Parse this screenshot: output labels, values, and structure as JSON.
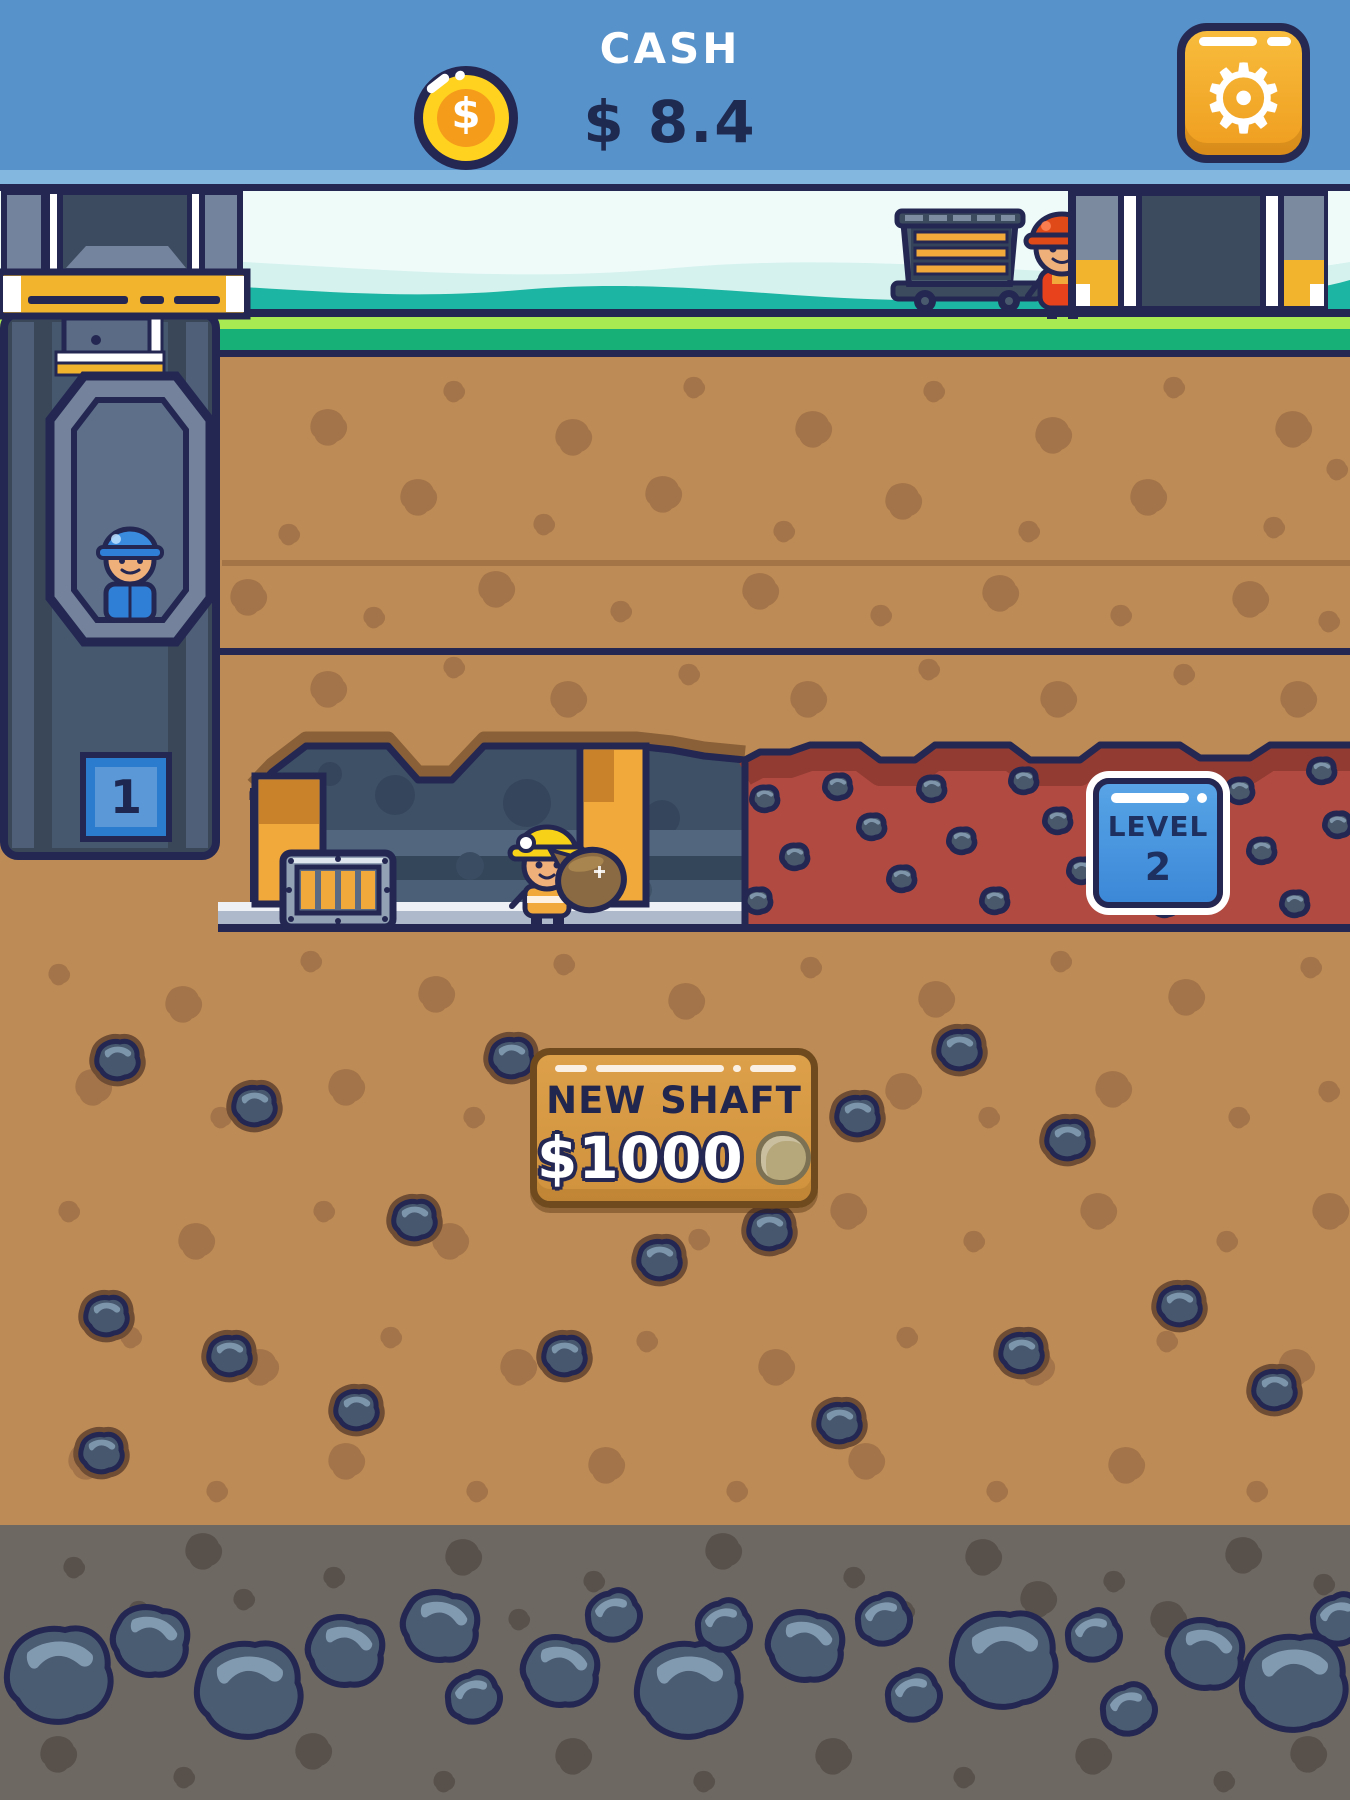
{
  "header": {
    "title": "CASH",
    "cash_value": "$ 8.4",
    "coin_symbol": "$",
    "gear_glyph": "⚙"
  },
  "shaft1": {
    "badge": "1"
  },
  "level2": {
    "label": "LEVEL",
    "number": "2"
  },
  "new_shaft": {
    "title": "NEW SHAFT",
    "price": "$1000"
  },
  "icons": {
    "coin": "dollar-coin-icon",
    "settings": "gear-icon",
    "nugget": "ore-nugget-icon"
  },
  "colors": {
    "header_blue": "#5892cb",
    "header_strip": "#84b7e0",
    "outline_navy": "#232752",
    "sky": "#eefbf9",
    "hills_teal": "#1cb4a2",
    "grass_light": "#a8ea52",
    "grass_dark": "#17b077",
    "dirt": "#bd8b55",
    "tunnel": "#3e5066",
    "wood_post": "#f2a93c",
    "red_zone": "#b14b41",
    "rock_slate": "#47586e",
    "gray_layer": "#6e6862",
    "button_tan": "#d89b43",
    "badge_blue": "#3c88d8",
    "accent_yellow": "#f2b42c"
  }
}
